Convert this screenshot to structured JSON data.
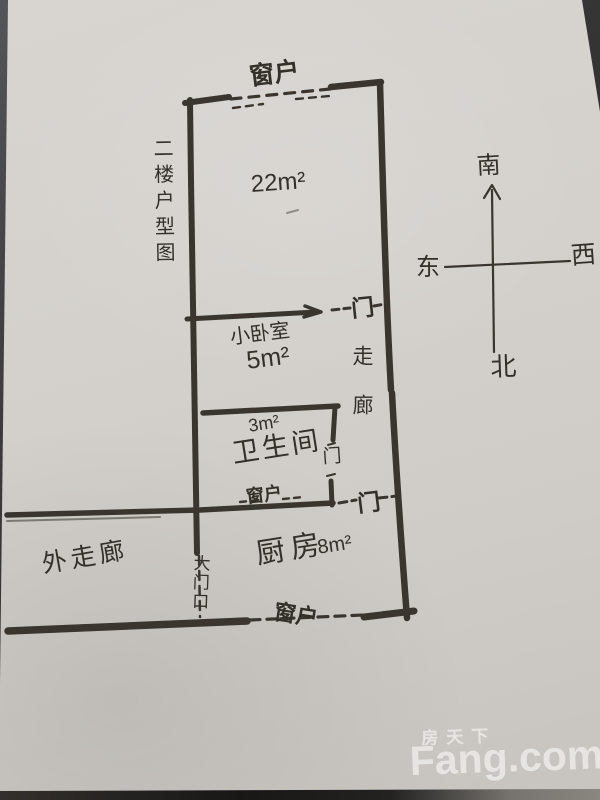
{
  "ink_color": "#3a362f",
  "paper_color": "#d3d0cb",
  "floor_plan": {
    "title": "二楼户型图",
    "labels": {
      "window_top": "窗户",
      "door_upper": "门",
      "main_room_area": "22m²",
      "bedroom_name": "小卧室",
      "bedroom_area": "5m²",
      "corridor": "走廊",
      "bathroom_area": "3m²",
      "bathroom_name": "卫生间",
      "bathroom_door": "门",
      "window_middle": "窗户",
      "kitchen_door": "门",
      "kitchen_name": "厨房",
      "kitchen_area": "8m²",
      "outer_corridor": "外走廊",
      "main_door": "大门口",
      "window_bottom": "窗户"
    }
  },
  "compass": {
    "south": "南",
    "east": "东",
    "west": "西",
    "north": "北"
  },
  "watermark": {
    "brand_cn": "房天下",
    "brand_en": "Fang.com"
  }
}
